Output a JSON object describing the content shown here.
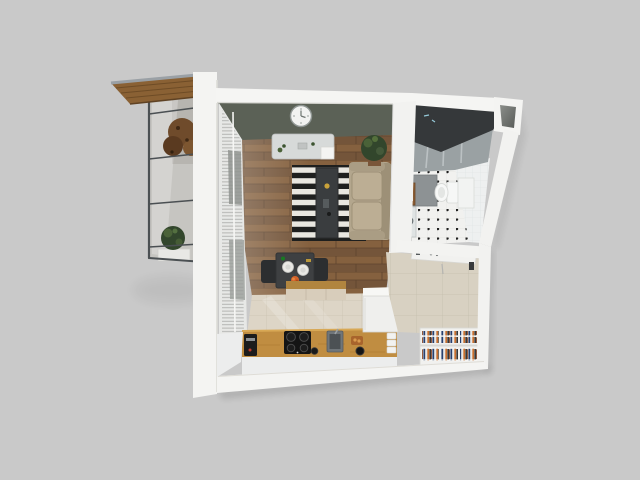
{
  "scene": {
    "description": "3D top-down dollhouse render of a studio apartment floor plan",
    "rooms": [
      {
        "name": "living-room",
        "floor": "dark wood planks",
        "items": [
          "ceiling-lamp-clock",
          "wall-console",
          "window-blinds",
          "striped-rug",
          "coffee-table",
          "sofa",
          "potted-plant",
          "dining-table",
          "dining-chairs",
          "plates"
        ]
      },
      {
        "name": "kitchen",
        "floor": "beige tiles",
        "items": [
          "wood-countertop",
          "coffee-machine",
          "induction-hob",
          "kitchen-sink",
          "cutting-board",
          "wine-bottle",
          "fridge-cabinet",
          "wine-rack",
          "peninsula-cabinet",
          "canisters"
        ]
      },
      {
        "name": "bathroom",
        "floor": "white tiles with black dots",
        "items": [
          "dark-ceiling",
          "shower-zone",
          "bath-mat",
          "toilet",
          "boiler-cabinet",
          "washing-machine",
          "vanity-sink",
          "window-niche"
        ]
      },
      {
        "name": "hallway",
        "floor": "large beige tiles",
        "items": [
          "console-shelf",
          "shoe-rack",
          "intercom"
        ]
      },
      {
        "name": "balcony",
        "items": [
          "wood-roof",
          "glass-railing",
          "green-bush",
          "dried-plant",
          "planter-box"
        ]
      }
    ]
  },
  "colors": {
    "background": "#c9c9c9",
    "wall": "#f4f4f2",
    "wall_inner": "#eceded",
    "ceiling_living": "#5b6156",
    "ceiling_bath": "#35383a",
    "clock_face": "#f2f3f1",
    "floor_wood": "#7b5a3c",
    "floor_wood_light": "#85613f",
    "floor_wood_dark": "#74553a",
    "floor_wood_seam": "#5d432d",
    "blinds_light": "#e7e8e6",
    "blinds_slat": "#aeb0ad",
    "blinds_dark": "#8f938f",
    "rug_dark": "#1e1f1e",
    "rug_light": "#e9e7e0",
    "coffee_table": "#3a3d3f",
    "sofa": "#b3a68d",
    "sofa_cushion": "#bcae94",
    "sofa_shade": "#9d9077",
    "plant_green": "#32462c",
    "plant_light": "#4a6238",
    "table_dark": "#3e4042",
    "chair_dark": "#2c2e30",
    "plate_white": "#eae9e5",
    "food_orange": "#d2622a",
    "kitchen_floor": "#ddd5c6",
    "kitchen_tile_seam": "#cbc2b0",
    "counter_wood": "#c08d41",
    "counter_wood_light": "#d8a855",
    "appliance_dark": "#1c1c1c",
    "sink_gray": "#70767a",
    "fridge_white": "#efefed",
    "bath_floor": "#f1f1ef",
    "bath_dot": "#1f1f1f",
    "shower_gray": "#9aa1a3",
    "tile_white": "#eef0f0",
    "tile_seam": "#dde1e1",
    "fixture_white": "#f6f7f6",
    "washer_gray": "#dfe3e3",
    "mat_gray": "#8d9294",
    "hall_floor": "#d8d1c2",
    "hall_tile_seam": "#c6bead",
    "shelf_white": "#f1f1ef",
    "spine_blue": "#27406e",
    "spine_orange": "#c87030",
    "spine_white": "#e8e8e6",
    "spine_black": "#242424",
    "spine_brown": "#8a4a2a",
    "balcony_roof": "#8a6134",
    "balcony_roof_seam": "#6e4c26",
    "railing_frame": "#4b5053",
    "concrete": "#c6c5c1",
    "dried_plant": "#6f4b2b",
    "niche_recess": "#707370"
  }
}
